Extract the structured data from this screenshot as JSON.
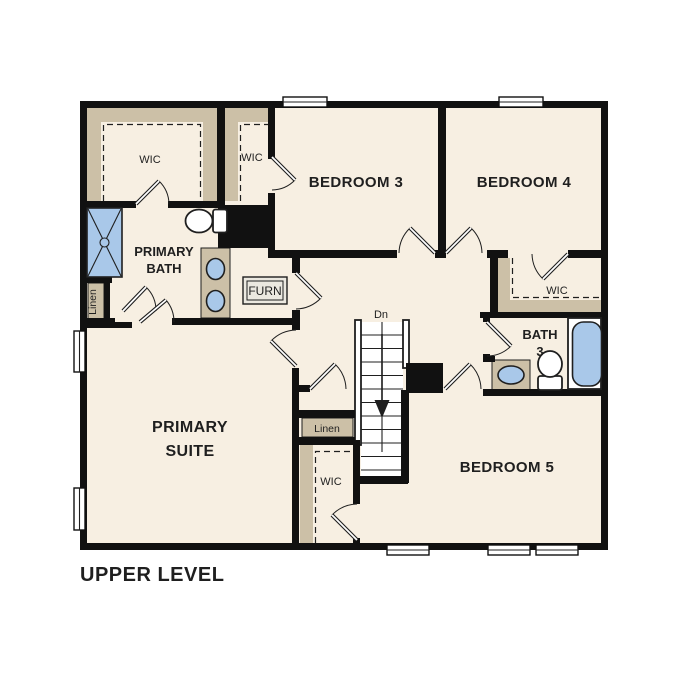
{
  "title": "UPPER LEVEL",
  "colors": {
    "wall": "#111111",
    "floor": "#f7efe2",
    "shelf": "#ccc0a7",
    "fixture": "#a9c8e9",
    "line": "#1f1f1f",
    "paper": "#ffffff"
  },
  "rooms": {
    "wic_primary": "WIC",
    "wic_bedroom3": "WIC",
    "bedroom3": "BEDROOM 3",
    "bedroom4": "BEDROOM 4",
    "primary_bath_line1": "PRIMARY",
    "primary_bath_line2": "BATH",
    "furnace": "FURN",
    "wic_bedroom4": "WIC",
    "bath3_line1": "BATH",
    "bath3_line2": "3",
    "linen_left": "Linen",
    "primary_suite_line1": "PRIMARY",
    "primary_suite_line2": "SUITE",
    "linen_center": "Linen",
    "wic_bedroom5": "WIC",
    "bedroom5": "BEDROOM 5",
    "stairs_direction": "Dn"
  }
}
